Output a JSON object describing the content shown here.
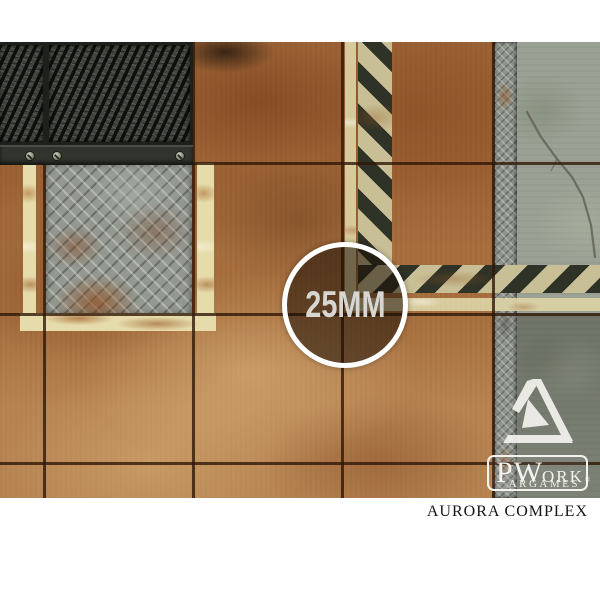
{
  "badge": {
    "label": "25MM",
    "ring_color": "#ffffff",
    "text_color": "#d8d6d2"
  },
  "logo": {
    "p": "P",
    "w": "W",
    "ork": "ORK",
    "reg": "®",
    "argames": "ARGAMES",
    "color": "#f4f3ef"
  },
  "caption": {
    "title": "AURORA COMPLEX",
    "color": "#141414"
  },
  "palette": {
    "page_background": "#ffffff",
    "rust": "#a8703f",
    "rust_dark": "#6e3d1c",
    "rust_light": "#c99a66",
    "mesh_grate": "#3f433b",
    "diamond_plate": "#939890",
    "concrete": "#9ba295",
    "concrete_dark": "#70726a",
    "cream_paint": "#e6dcab",
    "hazard_black": "#20241d",
    "grid_line": "#301808"
  }
}
